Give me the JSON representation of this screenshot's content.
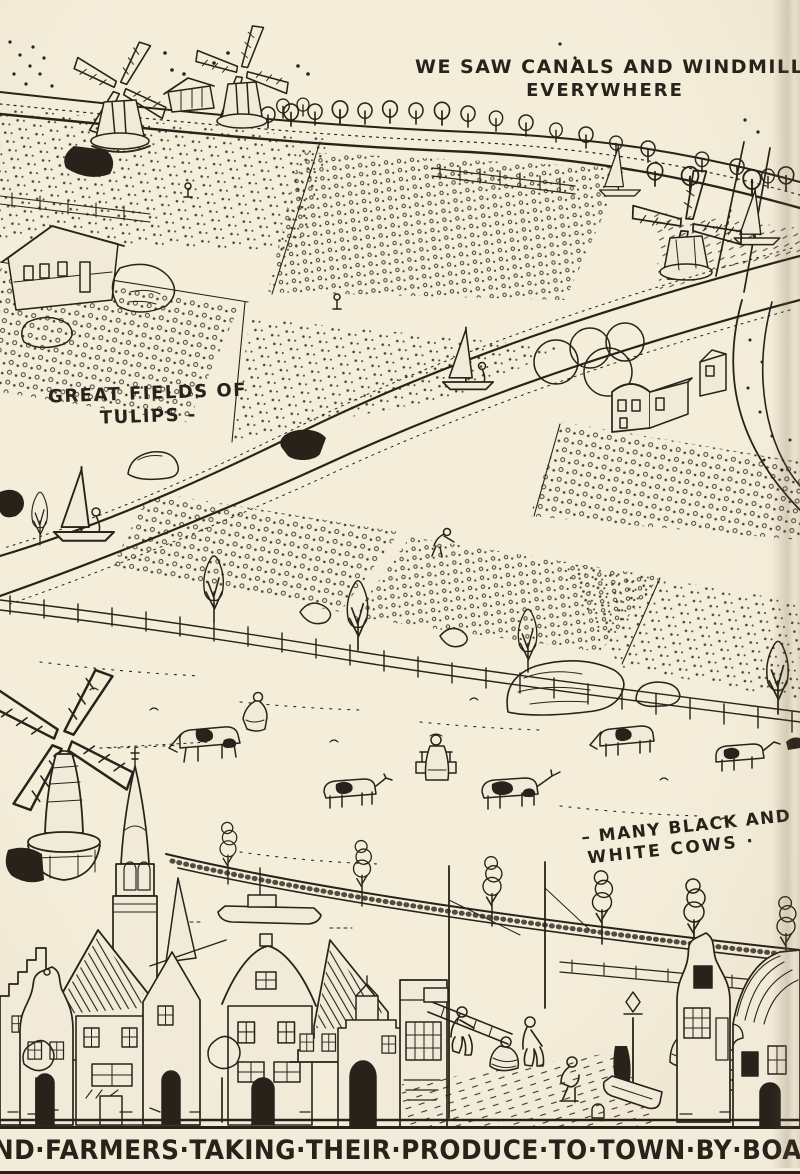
{
  "palette": {
    "paper": "#f1ead8",
    "ink": "#28221a",
    "shade": "#e0d7bf"
  },
  "captions": {
    "canals_line1": "WE SAW CANALS AND WINDMILLS",
    "canals_line2": "EVERYWHERE",
    "tulips_line1": "GREAT FIELDS OF",
    "tulips_line2": "TULIPS -",
    "cows_line1": "– MANY BLACK AND",
    "cows_line2": "WHITE COWS ·",
    "footer": "AND·FARMERS·TAKING·THEIR·PRODUCE·TO·TOWN·BY·BOAT·"
  }
}
